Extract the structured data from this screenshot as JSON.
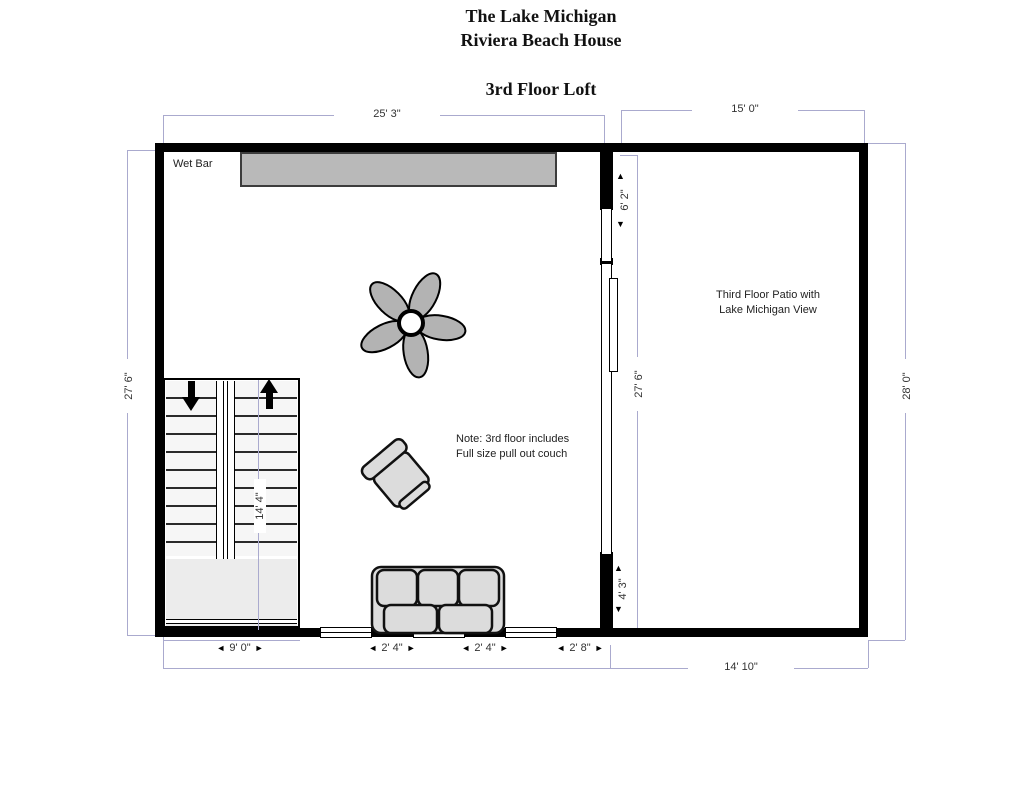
{
  "title": {
    "line1": "The Lake Michigan",
    "line2": "Riviera Beach House",
    "line3": "3rd Floor Loft"
  },
  "labels": {
    "wet_bar": "Wet Bar",
    "patio_line1": "Third Floor Patio with",
    "patio_line2": "Lake Michigan View",
    "note_line1": "Note: 3rd floor includes",
    "note_line2": "Full size pull out couch"
  },
  "dimensions": {
    "loft_width_top": "25' 3\"",
    "patio_width_top": "15' 0\"",
    "loft_height_left": "27' 6\"",
    "patio_height_right": "28' 0\"",
    "patio_height_inner": "27' 6\"",
    "divider_window": "6' 2\"",
    "divider_lower_wall": "4' 3\"",
    "stairs_run": "14' 4\"",
    "stairs_width_bottom": "9' 0\"",
    "window1_width": "2' 4\"",
    "window2_width": "2' 4\"",
    "window3_width": "2' 8\"",
    "patio_width_bottom": "14' 10\""
  },
  "icons": {
    "arrow_left": "◄",
    "arrow_right": "►",
    "arrow_up": "▲",
    "arrow_down": "▼",
    "stairs_down_arrow": "css-solid-arrow-down",
    "stairs_up_arrow": "css-solid-arrow-up",
    "ceiling_fan": "svg-5-blade-fan",
    "armchair": "svg-armchair",
    "couch": "svg-3-seat-couch"
  },
  "colors": {
    "wall": "#000000",
    "dimension_line": "#aaaace",
    "counter_fill": "#b9b9b9",
    "furniture_fill": "#dcdcdc",
    "fan_blade": "#b3b3b3",
    "text": "#222222"
  }
}
